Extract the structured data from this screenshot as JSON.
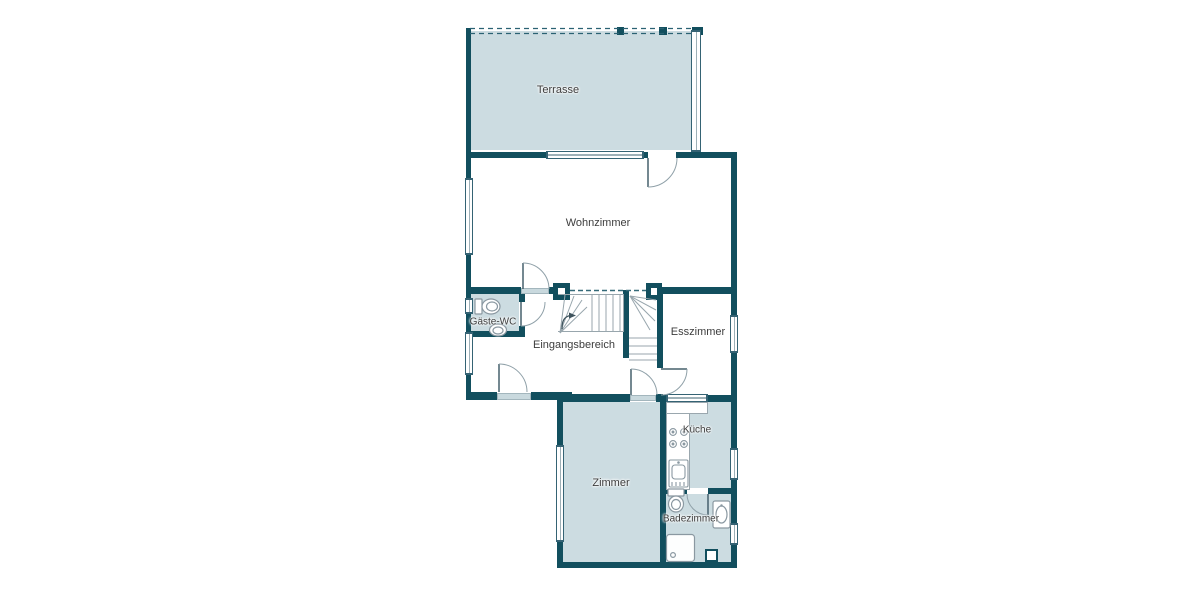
{
  "plan": {
    "type": "floor-plan",
    "language": "de"
  },
  "rooms": [
    {
      "id": "terrasse",
      "label": "Terrasse",
      "shaded": true
    },
    {
      "id": "wohnzimmer",
      "label": "Wohnzimmer",
      "shaded": false
    },
    {
      "id": "gaeste_wc",
      "label": "Gäste-WC",
      "shaded": true
    },
    {
      "id": "eingangsbereich",
      "label": "Eingangsbereich",
      "shaded": false
    },
    {
      "id": "esszimmer",
      "label": "Esszimmer",
      "shaded": false
    },
    {
      "id": "zimmer",
      "label": "Zimmer",
      "shaded": true
    },
    {
      "id": "kueche",
      "label": "Küche",
      "shaded": true
    },
    {
      "id": "badezimmer",
      "label": "Badezimmer",
      "shaded": true
    }
  ],
  "palette": {
    "wall": "#124f5e",
    "room_fill": "#ccdce1",
    "sill": "#c9d9de",
    "window_frame": "#356374",
    "fixture_stroke": "#8a98a1",
    "door_arc": "#8fa0a8",
    "door_leaf": "#46606c",
    "stair_stroke": "#98a6ad",
    "text": "#3d3d3d",
    "background": "#ffffff"
  },
  "icons": {
    "toilet": "wc-toilet-icon",
    "sink": "sink-icon",
    "stove": "stove-burners-icon",
    "kitchen_sink": "kitchen-sink-icon",
    "shower": "shower-tray-icon",
    "stairs": "winder-stairs-icon",
    "door_swing": "door-swing-arc",
    "direction_arrow": "stair-direction-arrow"
  }
}
